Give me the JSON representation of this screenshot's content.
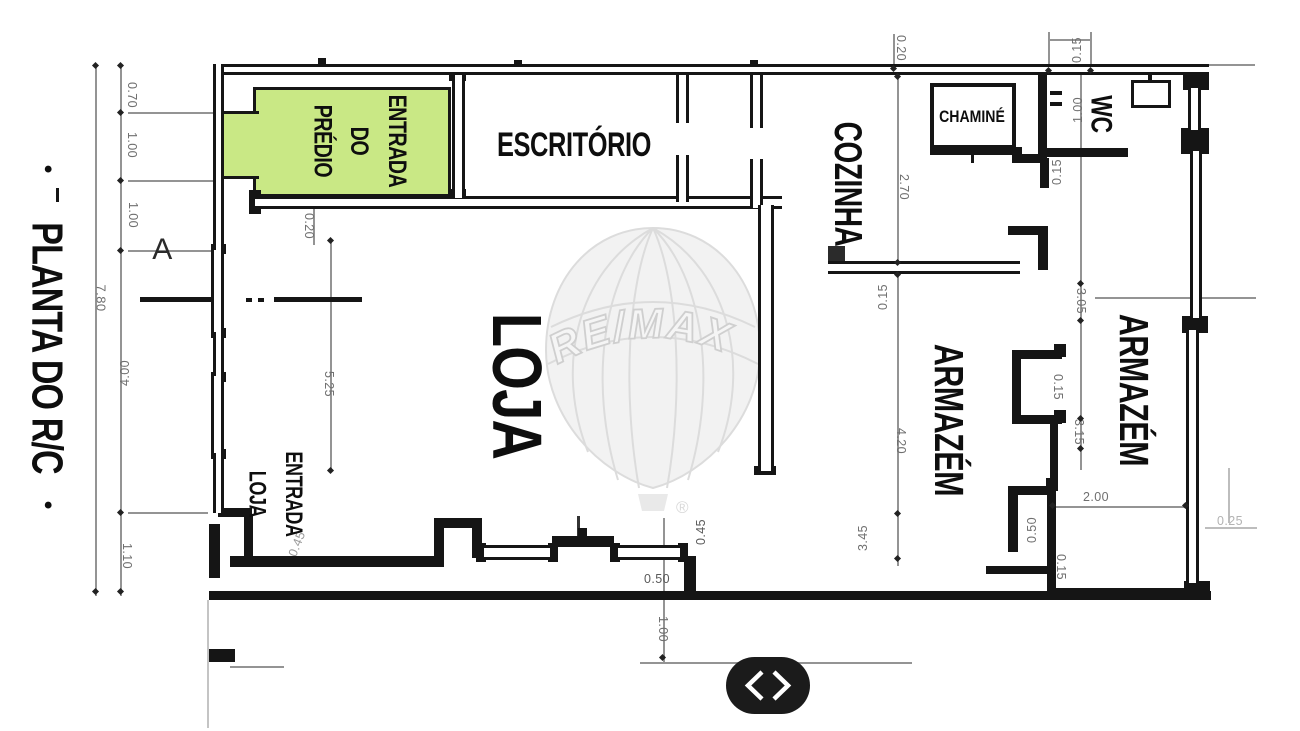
{
  "plan": {
    "title": "PLANTA DO R/C",
    "title_bullet": "•",
    "section_label": "A",
    "rooms": {
      "entrada_predio": {
        "line1": "ENTRADA",
        "line2": "DO",
        "line3": "PRÉDIO"
      },
      "escritorio": "ESCRITÓRIO",
      "cozinha": "COZINHA",
      "chamine": "CHAMINÉ",
      "wc": "WC",
      "loja": "LOJA",
      "entrada_loja": {
        "line1": "ENTRADA",
        "line2": "LOJA"
      },
      "armazem_center": "ARMAZÉM",
      "armazem_right": "ARMAZÉM"
    },
    "dimensions": {
      "left_0_70": "0.70",
      "left_1_00a": "1.00",
      "left_1_00b": "1.00",
      "left_7_80": "7.80",
      "left_4_00": "4.00",
      "left_1_10": "1.10",
      "loja_0_20": "0.20",
      "loja_5_25": "5.25",
      "loja_0_45": "0.45",
      "top_0_20": "0.20",
      "top_0_15": "0.15",
      "wc_1_00": "1.00",
      "wc_0_15": "0.15",
      "coz_2_70": "2.70",
      "coz_0_15": "0.15",
      "mid_4_20": "4.20",
      "mid_3_45": "3.45",
      "right_3_05": "3.05",
      "right_0_15": "0.15",
      "right_3_15": "3.15",
      "right_2_00": "2.00",
      "right_0_50": "0.50",
      "right_0_15b": "0.15",
      "right_0_25": "0.25",
      "bot_0_45": "0.45",
      "bot_0_50": "0.50",
      "bot_1_00": "1.00"
    },
    "watermark": {
      "brand": "RE/MAX",
      "registered": "®"
    },
    "nav": {
      "prev_icon": "chevron-left",
      "next_icon": "chevron-right"
    },
    "colors": {
      "highlight": "#c9e885",
      "wall": "#151515",
      "dim": "#6f6f6f"
    }
  }
}
